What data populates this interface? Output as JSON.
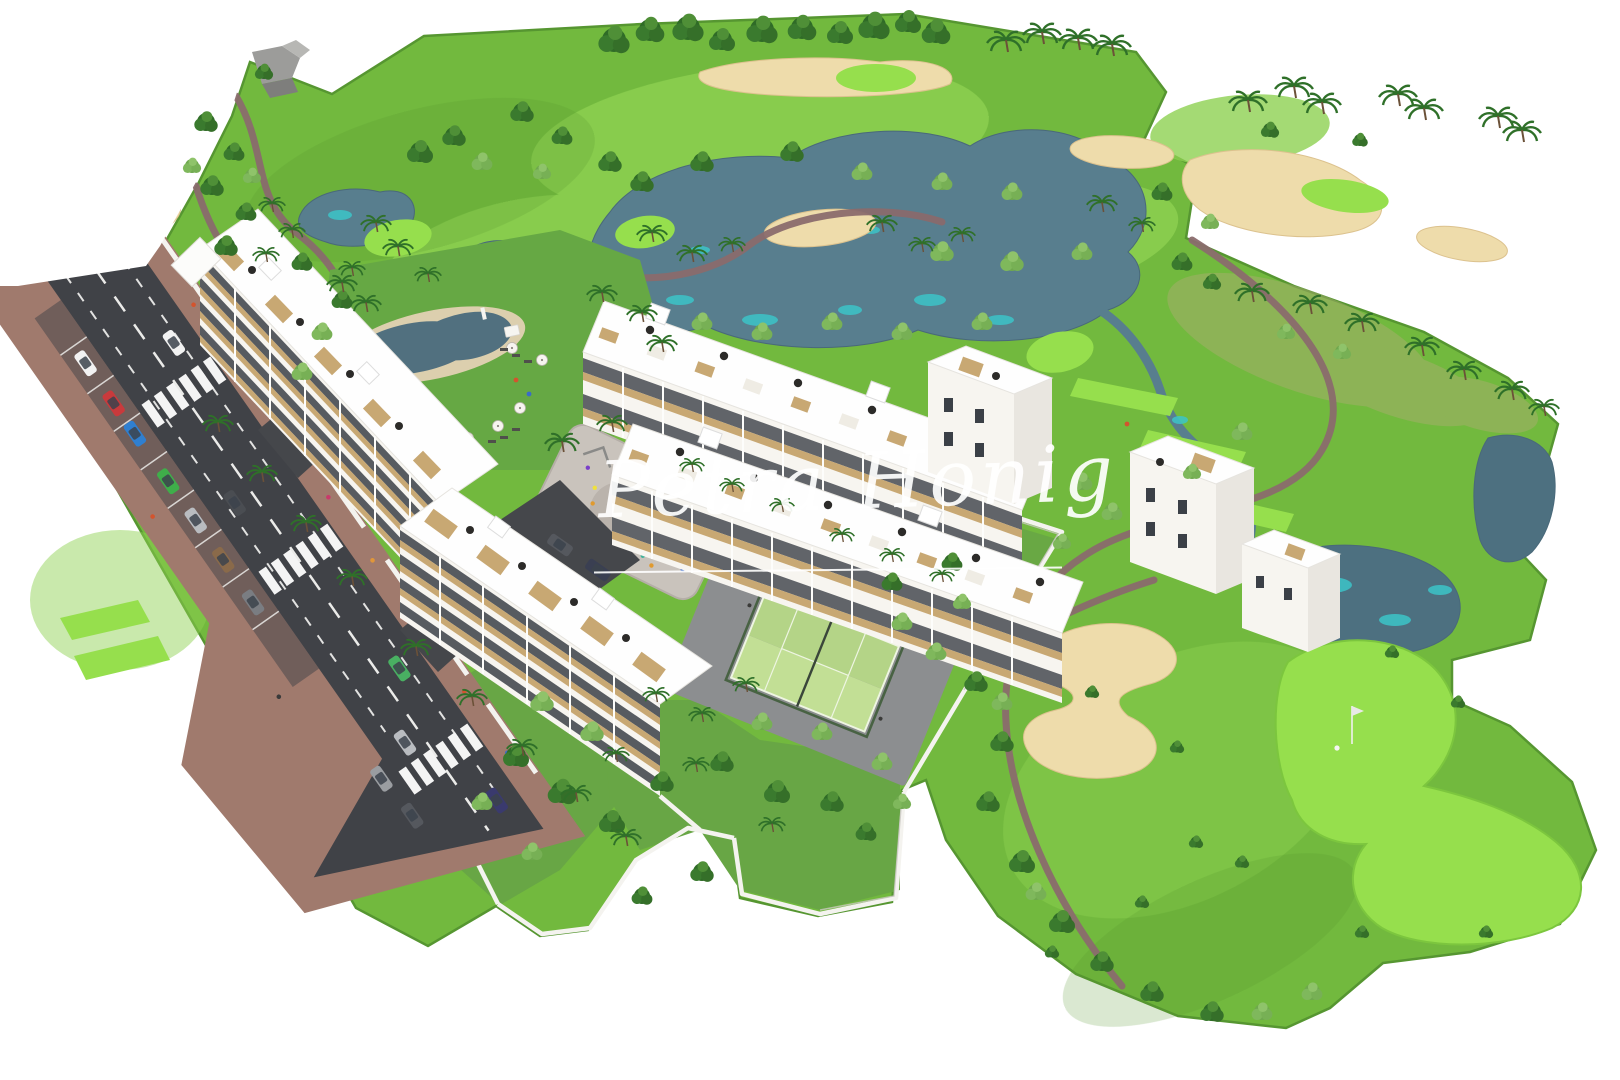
{
  "watermark": {
    "text": "Petra Honig"
  },
  "palette": {
    "bg": "#ffffff",
    "fairway": "#72b93e",
    "fairway-light": "#8ed152",
    "rough": "#569631",
    "green-bright": "#96df4d",
    "sand": "#eedcab",
    "water": "#587e8e",
    "water-dark": "#4d7080",
    "water-teal": "#3cc4c8",
    "path": "#8a6b6d",
    "road": "#404247",
    "sidewalk": "#a07a6d",
    "wall": "#f4f3ef",
    "wood": "#c8a873",
    "glass": "#3b4047",
    "building": "#f7f5f0",
    "roof": "#fefefe",
    "pool-water": "#51707f",
    "pool-beach": "#dccfae",
    "pool-lawn": "#66a844",
    "garden-lawn": "#68a645",
    "padel-a": "#b4d487",
    "padel-b": "#c2df95",
    "fence": "#44603f",
    "pad": "#c9c3bc",
    "dark": "#2c2b29"
  }
}
